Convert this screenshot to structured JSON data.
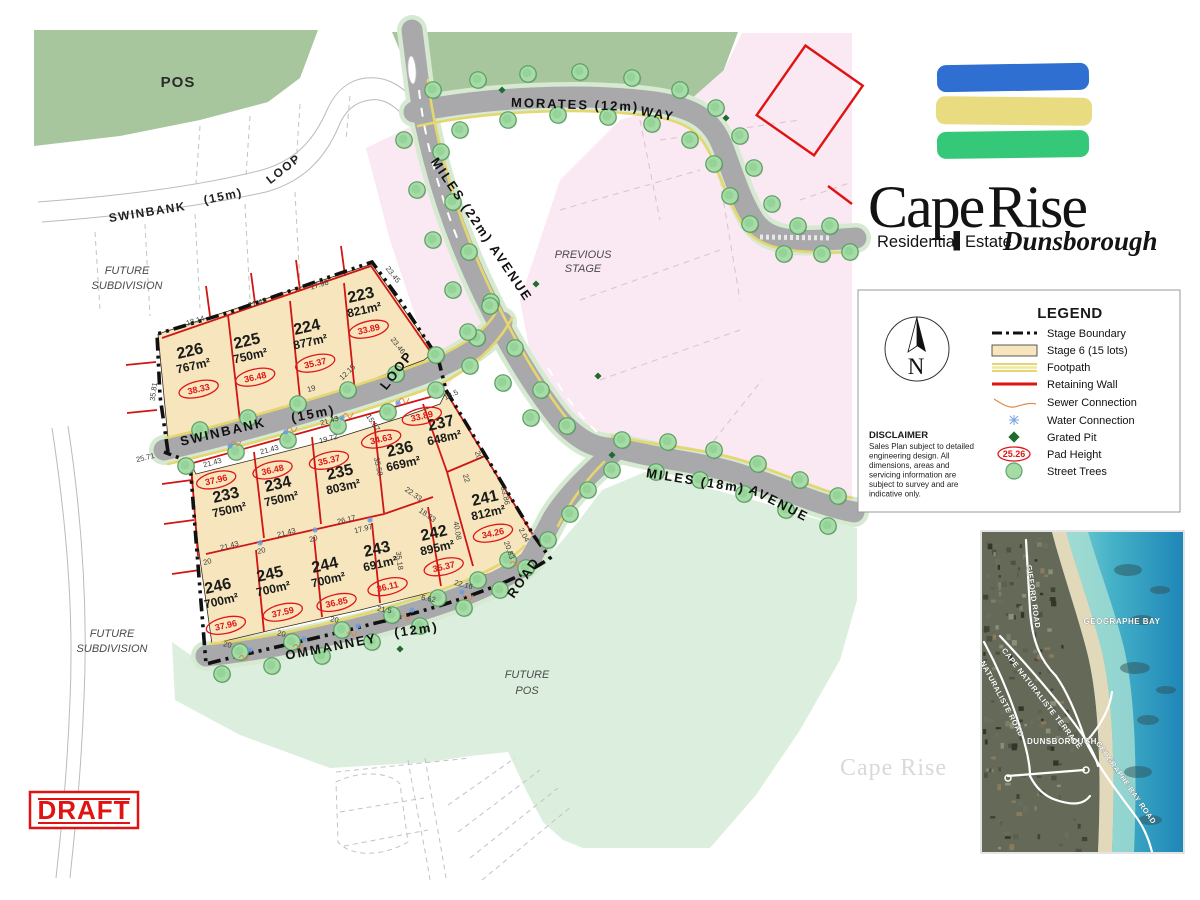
{
  "logo": {
    "cape": "Cape",
    "rise": "Rise",
    "residential": "Residential",
    "estate": "Estate",
    "locality": "Dunsborough",
    "stripe_colors": [
      "#2e6fd1",
      "#e9db7f",
      "#35c878"
    ]
  },
  "draft": {
    "label": "DRAFT",
    "color": "#e01212"
  },
  "watermark": {
    "text": "Cape Rise"
  },
  "compass": {
    "n": "N"
  },
  "legend": {
    "title": "LEGEND",
    "pad_sample": "25.26",
    "items": [
      {
        "label": "Stage Boundary"
      },
      {
        "label": "Stage 6 (15 lots)"
      },
      {
        "label": "Footpath"
      },
      {
        "label": "Retaining Wall"
      },
      {
        "label": "Sewer Connection"
      },
      {
        "label": "Water Connection"
      },
      {
        "label": "Grated Pit"
      },
      {
        "label": "Pad Height"
      },
      {
        "label": "Street Trees"
      }
    ]
  },
  "disclaimer": {
    "title": "DISCLAIMER",
    "lines": [
      "Sales Plan subject to detailed",
      "engineering design. All",
      "dimensions, areas and",
      "servicing information are",
      "subject to survey and are",
      "indicative only."
    ]
  },
  "areas": {
    "pos": "POS",
    "previous_stage_1": "PREVIOUS",
    "previous_stage_2": "STAGE",
    "future_subdivision_1": "FUTURE",
    "future_subdivision_2": "SUBDIVISION",
    "future_pos_1": "FUTURE",
    "future_pos_2": "POS"
  },
  "streets": {
    "morates_name": "MORATES  (12m)",
    "morates_suffix": "WAY",
    "miles22": "MILES  (22m)  AVENUE",
    "swinbank_name": "SWINBANK",
    "swinbank_size": "(15m)",
    "swinbank_suffix": "LOOP",
    "miles18_name": "MILES  (18m)",
    "miles18_suffix": "AVENUE",
    "ommanney_name": "OMMANNEY",
    "ommanney_size": "(12m)",
    "ommanney_suffix": "ROAD"
  },
  "lots": [
    {
      "number": "223",
      "area": "821m²",
      "pad": "33.89"
    },
    {
      "number": "224",
      "area": "877m²",
      "pad": "35.37"
    },
    {
      "number": "225",
      "area": "750m²",
      "pad": "36.48"
    },
    {
      "number": "226",
      "area": "767m²",
      "pad": "38.33"
    },
    {
      "number": "233",
      "area": "750m²",
      "pad": "37.96"
    },
    {
      "number": "234",
      "area": "750m²",
      "pad": "36.48"
    },
    {
      "number": "235",
      "area": "803m²",
      "pad": "35.37"
    },
    {
      "number": "236",
      "area": "669m²",
      "pad": "34.63"
    },
    {
      "number": "237",
      "area": "648m²",
      "pad": "33.89"
    },
    {
      "number": "241",
      "area": "812m²",
      "pad": "34.26"
    },
    {
      "number": "242",
      "area": "895m²",
      "pad": "35.37"
    },
    {
      "number": "243",
      "area": "691m²",
      "pad": "36.11"
    },
    {
      "number": "244",
      "area": "700m²",
      "pad": "36.85"
    },
    {
      "number": "245",
      "area": "700m²",
      "pad": "37.59"
    },
    {
      "number": "246",
      "area": "700m²",
      "pad": "37.96"
    }
  ],
  "dimensions": [
    {
      "v": "18.14",
      "x": 196,
      "y": 323,
      "r": -17
    },
    {
      "v": "21.43",
      "x": 258,
      "y": 305,
      "r": -17
    },
    {
      "v": "17.98",
      "x": 320,
      "y": 287,
      "r": -17
    },
    {
      "v": "23.45",
      "x": 391,
      "y": 276,
      "r": 52
    },
    {
      "v": "35.81",
      "x": 156,
      "y": 392,
      "r": -82
    },
    {
      "v": "25.71",
      "x": 146,
      "y": 460,
      "r": -14
    },
    {
      "v": "21.43",
      "x": 330,
      "y": 423,
      "r": -16
    },
    {
      "v": "19",
      "x": 312,
      "y": 391,
      "r": -16
    },
    {
      "v": "12.15",
      "x": 349,
      "y": 374,
      "r": -44
    },
    {
      "v": "23.46",
      "x": 396,
      "y": 347,
      "r": 52
    },
    {
      "v": "21.43",
      "x": 213,
      "y": 465,
      "r": -15
    },
    {
      "v": "21.43",
      "x": 270,
      "y": 452,
      "r": -15
    },
    {
      "v": "19.72",
      "x": 329,
      "y": 441,
      "r": -15
    },
    {
      "v": "15.87",
      "x": 371,
      "y": 424,
      "r": 57
    },
    {
      "v": "18.5",
      "x": 452,
      "y": 397,
      "r": -25
    },
    {
      "v": "35.58",
      "x": 376,
      "y": 467,
      "r": 78
    },
    {
      "v": "22.33",
      "x": 412,
      "y": 496,
      "r": 35
    },
    {
      "v": "18.83",
      "x": 426,
      "y": 517,
      "r": 35
    },
    {
      "v": "26.17",
      "x": 347,
      "y": 522,
      "r": -14
    },
    {
      "v": "17.97",
      "x": 364,
      "y": 531,
      "r": -14
    },
    {
      "v": "22",
      "x": 464,
      "y": 479,
      "r": 72
    },
    {
      "v": "20",
      "x": 476,
      "y": 456,
      "r": 72
    },
    {
      "v": "33.86",
      "x": 503,
      "y": 496,
      "r": 78
    },
    {
      "v": "2.04",
      "x": 522,
      "y": 536,
      "r": 62
    },
    {
      "v": "20.83",
      "x": 507,
      "y": 551,
      "r": 70
    },
    {
      "v": "40.08",
      "x": 455,
      "y": 531,
      "r": 80
    },
    {
      "v": "22.16",
      "x": 463,
      "y": 587,
      "r": 14
    },
    {
      "v": "6.62",
      "x": 428,
      "y": 601,
      "r": 10
    },
    {
      "v": "21.5",
      "x": 384,
      "y": 612,
      "r": 10
    },
    {
      "v": "35.18",
      "x": 397,
      "y": 561,
      "r": 82
    },
    {
      "v": "21.43",
      "x": 230,
      "y": 548,
      "r": -15
    },
    {
      "v": "21.43",
      "x": 287,
      "y": 535,
      "r": -15
    },
    {
      "v": "20",
      "x": 208,
      "y": 564,
      "r": -15
    },
    {
      "v": "20",
      "x": 262,
      "y": 553,
      "r": -15
    },
    {
      "v": "20",
      "x": 314,
      "y": 541,
      "r": -15
    },
    {
      "v": "20",
      "x": 227,
      "y": 647,
      "r": 12
    },
    {
      "v": "20",
      "x": 281,
      "y": 636,
      "r": 12
    },
    {
      "v": "20",
      "x": 334,
      "y": 622,
      "r": 12
    }
  ],
  "location_map": {
    "geographe_bay": "GEOGRAPHE BAY",
    "gifford_road": "GIFFORD ROAD",
    "cape_naturaliste_terrace": "CAPE NATURALISTE TERRACE",
    "naturaliste_road": "NATURALISTE ROAD",
    "dunsborough": "DUNSBOROUGH",
    "geographe_bay_road": "GEOGRAPHE BAY ROAD"
  }
}
